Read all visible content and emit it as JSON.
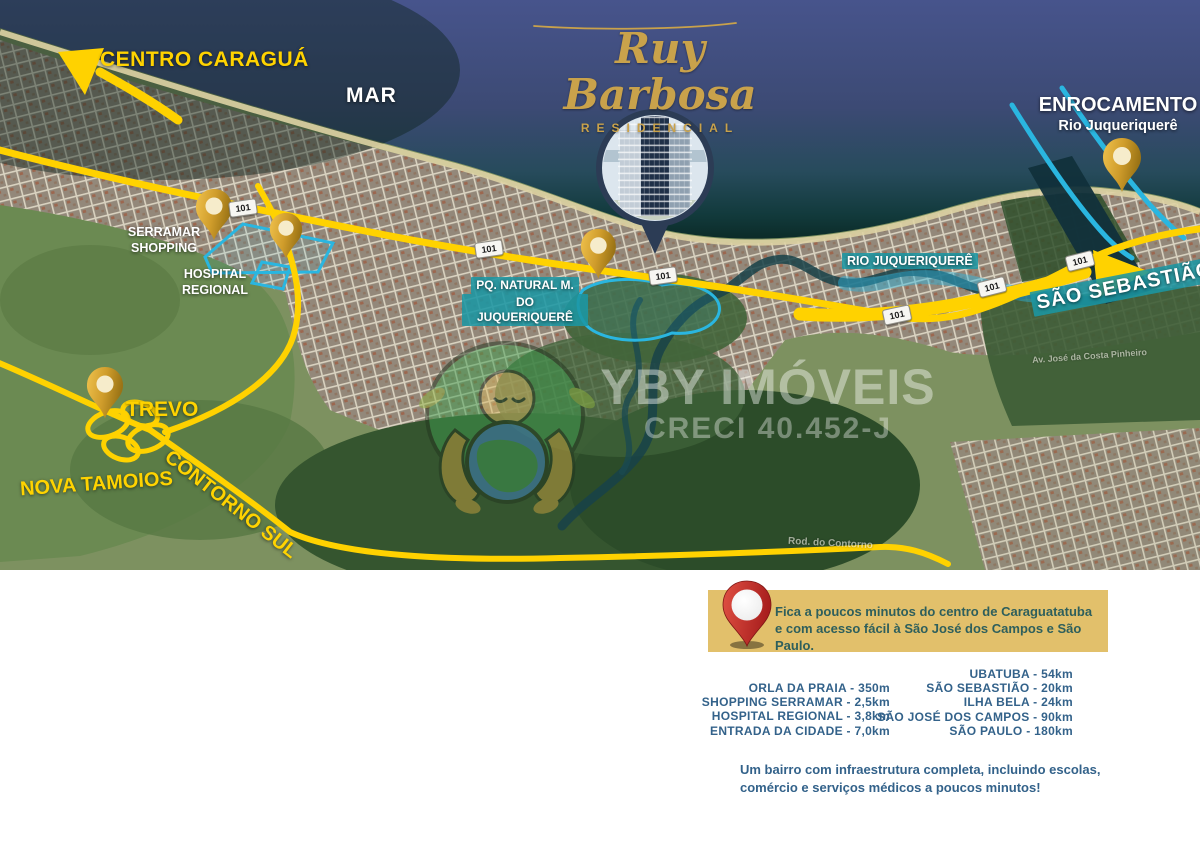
{
  "map": {
    "sea_label": "MAR",
    "centro_arrow": "CENTRO CARAGUÁ",
    "logo": {
      "name": "Ruy Barbosa",
      "subtitle": "RESIDENCIAL"
    },
    "enrocamento": {
      "title": "ENROCAMENTO",
      "subtitle": "Rio Juqueriquerê"
    },
    "labels": {
      "serramar": {
        "line1": "SERRAMAR",
        "line2": "SHOPPING"
      },
      "hospital": {
        "line1": "HOSPITAL",
        "line2": "REGIONAL"
      },
      "parque": {
        "line1": "PQ. NATURAL M.",
        "line2": "DO JUQUERIQUERÊ"
      },
      "rio": "RIO JUQUERIQUERÊ",
      "sao_sebastiao": "SÃO SEBASTIÃO",
      "trevo": "TREVO",
      "nova_tamoios": "NOVA TAMOIOS",
      "contorno_sul": "CONTORNO SUL"
    },
    "route_shield": "101",
    "street_names": {
      "rodovia": "Rod. do Contorno",
      "avenida": "Av. José da Costa Pinheiro"
    },
    "watermark": {
      "brand": "YBY IMÓVEIS",
      "creci": "CRECI 40.452-J"
    }
  },
  "info": {
    "callout": {
      "line1": "Fica a poucos minutos do centro de Caraguatatuba",
      "line2": "e com acesso fácil à São José dos Campos e São Paulo."
    },
    "distances_left": [
      "ORLA DA PRAIA - 350m",
      "SHOPPING SERRAMAR - 2,5km",
      "HOSPITAL REGIONAL - 3,8km",
      "ENTRADA DA CIDADE - 7,0km"
    ],
    "distances_right": [
      "UBATUBA - 54km",
      "SÃO SEBASTIÃO - 20km",
      "ILHA BELA - 24km",
      "SÃO JOSÉ DOS CAMPOS - 90km",
      "SÃO PAULO - 180km"
    ],
    "footer": {
      "line1": "Um bairro com infraestrutura completa, incluindo escolas,",
      "line2": "comércio e serviços médicos a poucos minutos!"
    }
  },
  "colors": {
    "road_yellow": "#FFD200",
    "pin_gold": "#D9A62E",
    "label_teal": "#1B96A3",
    "callout_bg": "#E2C06B",
    "list_text": "#33628A",
    "callout_text": "#2E5F5C",
    "sea_blue": "#3E4C78",
    "highlight_cyan": "#2AB6E0",
    "pin_red": "#C9302C",
    "logo_gold": "#C9A24B"
  }
}
